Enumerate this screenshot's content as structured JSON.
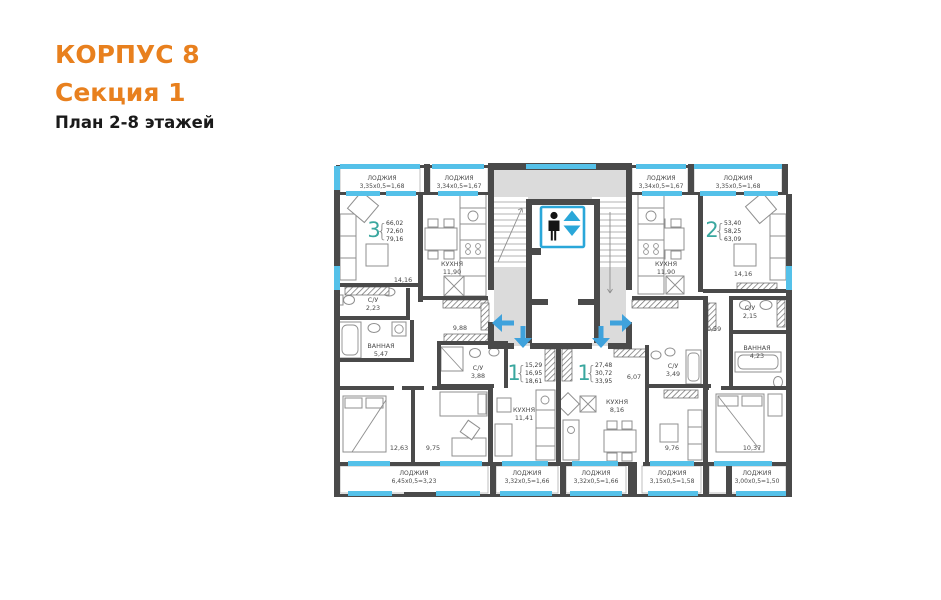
{
  "header": {
    "building": "КОРПУС 8",
    "section": "Секция 1",
    "floors": "План 2-8 этажей"
  },
  "colors": {
    "accent_orange": "#E8801E",
    "apartment_number_teal": "#3AA79F",
    "glazing_blue": "#55C1E9",
    "arrow_blue": "#3FA2DC",
    "elevator_blue": "#2AA7D9",
    "wall_dark": "#4A4A4A",
    "core_fill": "#DBDBDB"
  },
  "icons": {
    "elevator": "elevator-person-up-down-icon"
  },
  "apartments": [
    {
      "number": "3",
      "areas": [
        "66,02",
        "72,60",
        "79,16"
      ]
    },
    {
      "number": "2",
      "areas": [
        "53,40",
        "58,25",
        "63,09"
      ]
    },
    {
      "number": "1",
      "areas": [
        "15,29",
        "16,95",
        "18,61"
      ]
    },
    {
      "number": "1",
      "areas": [
        "27,48",
        "30,72",
        "33,95"
      ]
    }
  ],
  "loggias": [
    {
      "name": "ЛОДЖИЯ",
      "dims": "3,35х0,5=1,68"
    },
    {
      "name": "ЛОДЖИЯ",
      "dims": "3,34х0,5=1,67"
    },
    {
      "name": "ЛОДЖИЯ",
      "dims": "3,34х0,5=1,67"
    },
    {
      "name": "ЛОДЖИЯ",
      "dims": "3,35х0,5=1,68"
    },
    {
      "name": "ЛОДЖИЯ",
      "dims": "6,45х0,5=3,23"
    },
    {
      "name": "ЛОДЖИЯ",
      "dims": "3,32х0,5=1,66"
    },
    {
      "name": "ЛОДЖИЯ",
      "dims": "3,32х0,5=1,66"
    },
    {
      "name": "ЛОДЖИЯ",
      "dims": "3,15х0,5=1,58"
    },
    {
      "name": "ЛОДЖИЯ",
      "dims": "3,00х0,5=1,50"
    }
  ],
  "rooms": [
    {
      "name": "",
      "area": "14,16"
    },
    {
      "name": "КУХНЯ",
      "area": "11,90"
    },
    {
      "name": "С/У",
      "area": "2,23"
    },
    {
      "name": "ВАННАЯ",
      "area": "5,47"
    },
    {
      "name": "",
      "area": "12,63"
    },
    {
      "name": "",
      "area": "9,75"
    },
    {
      "name": "",
      "area": "9,88"
    },
    {
      "name": "С/У",
      "area": "3,88"
    },
    {
      "name": "КУХНЯ",
      "area": "11,41"
    },
    {
      "name": "КУХНЯ",
      "area": "8,16"
    },
    {
      "name": "",
      "area": "6,07"
    },
    {
      "name": "С/У",
      "area": "3,49"
    },
    {
      "name": "",
      "area": "9,76"
    },
    {
      "name": "",
      "area": "10,59"
    },
    {
      "name": "С/У",
      "area": "2,15"
    },
    {
      "name": "ВАННАЯ",
      "area": "4,23"
    },
    {
      "name": "",
      "area": "10,37"
    },
    {
      "name": "КУХНЯ",
      "area": "11,90"
    },
    {
      "name": "",
      "area": "14,16"
    }
  ]
}
